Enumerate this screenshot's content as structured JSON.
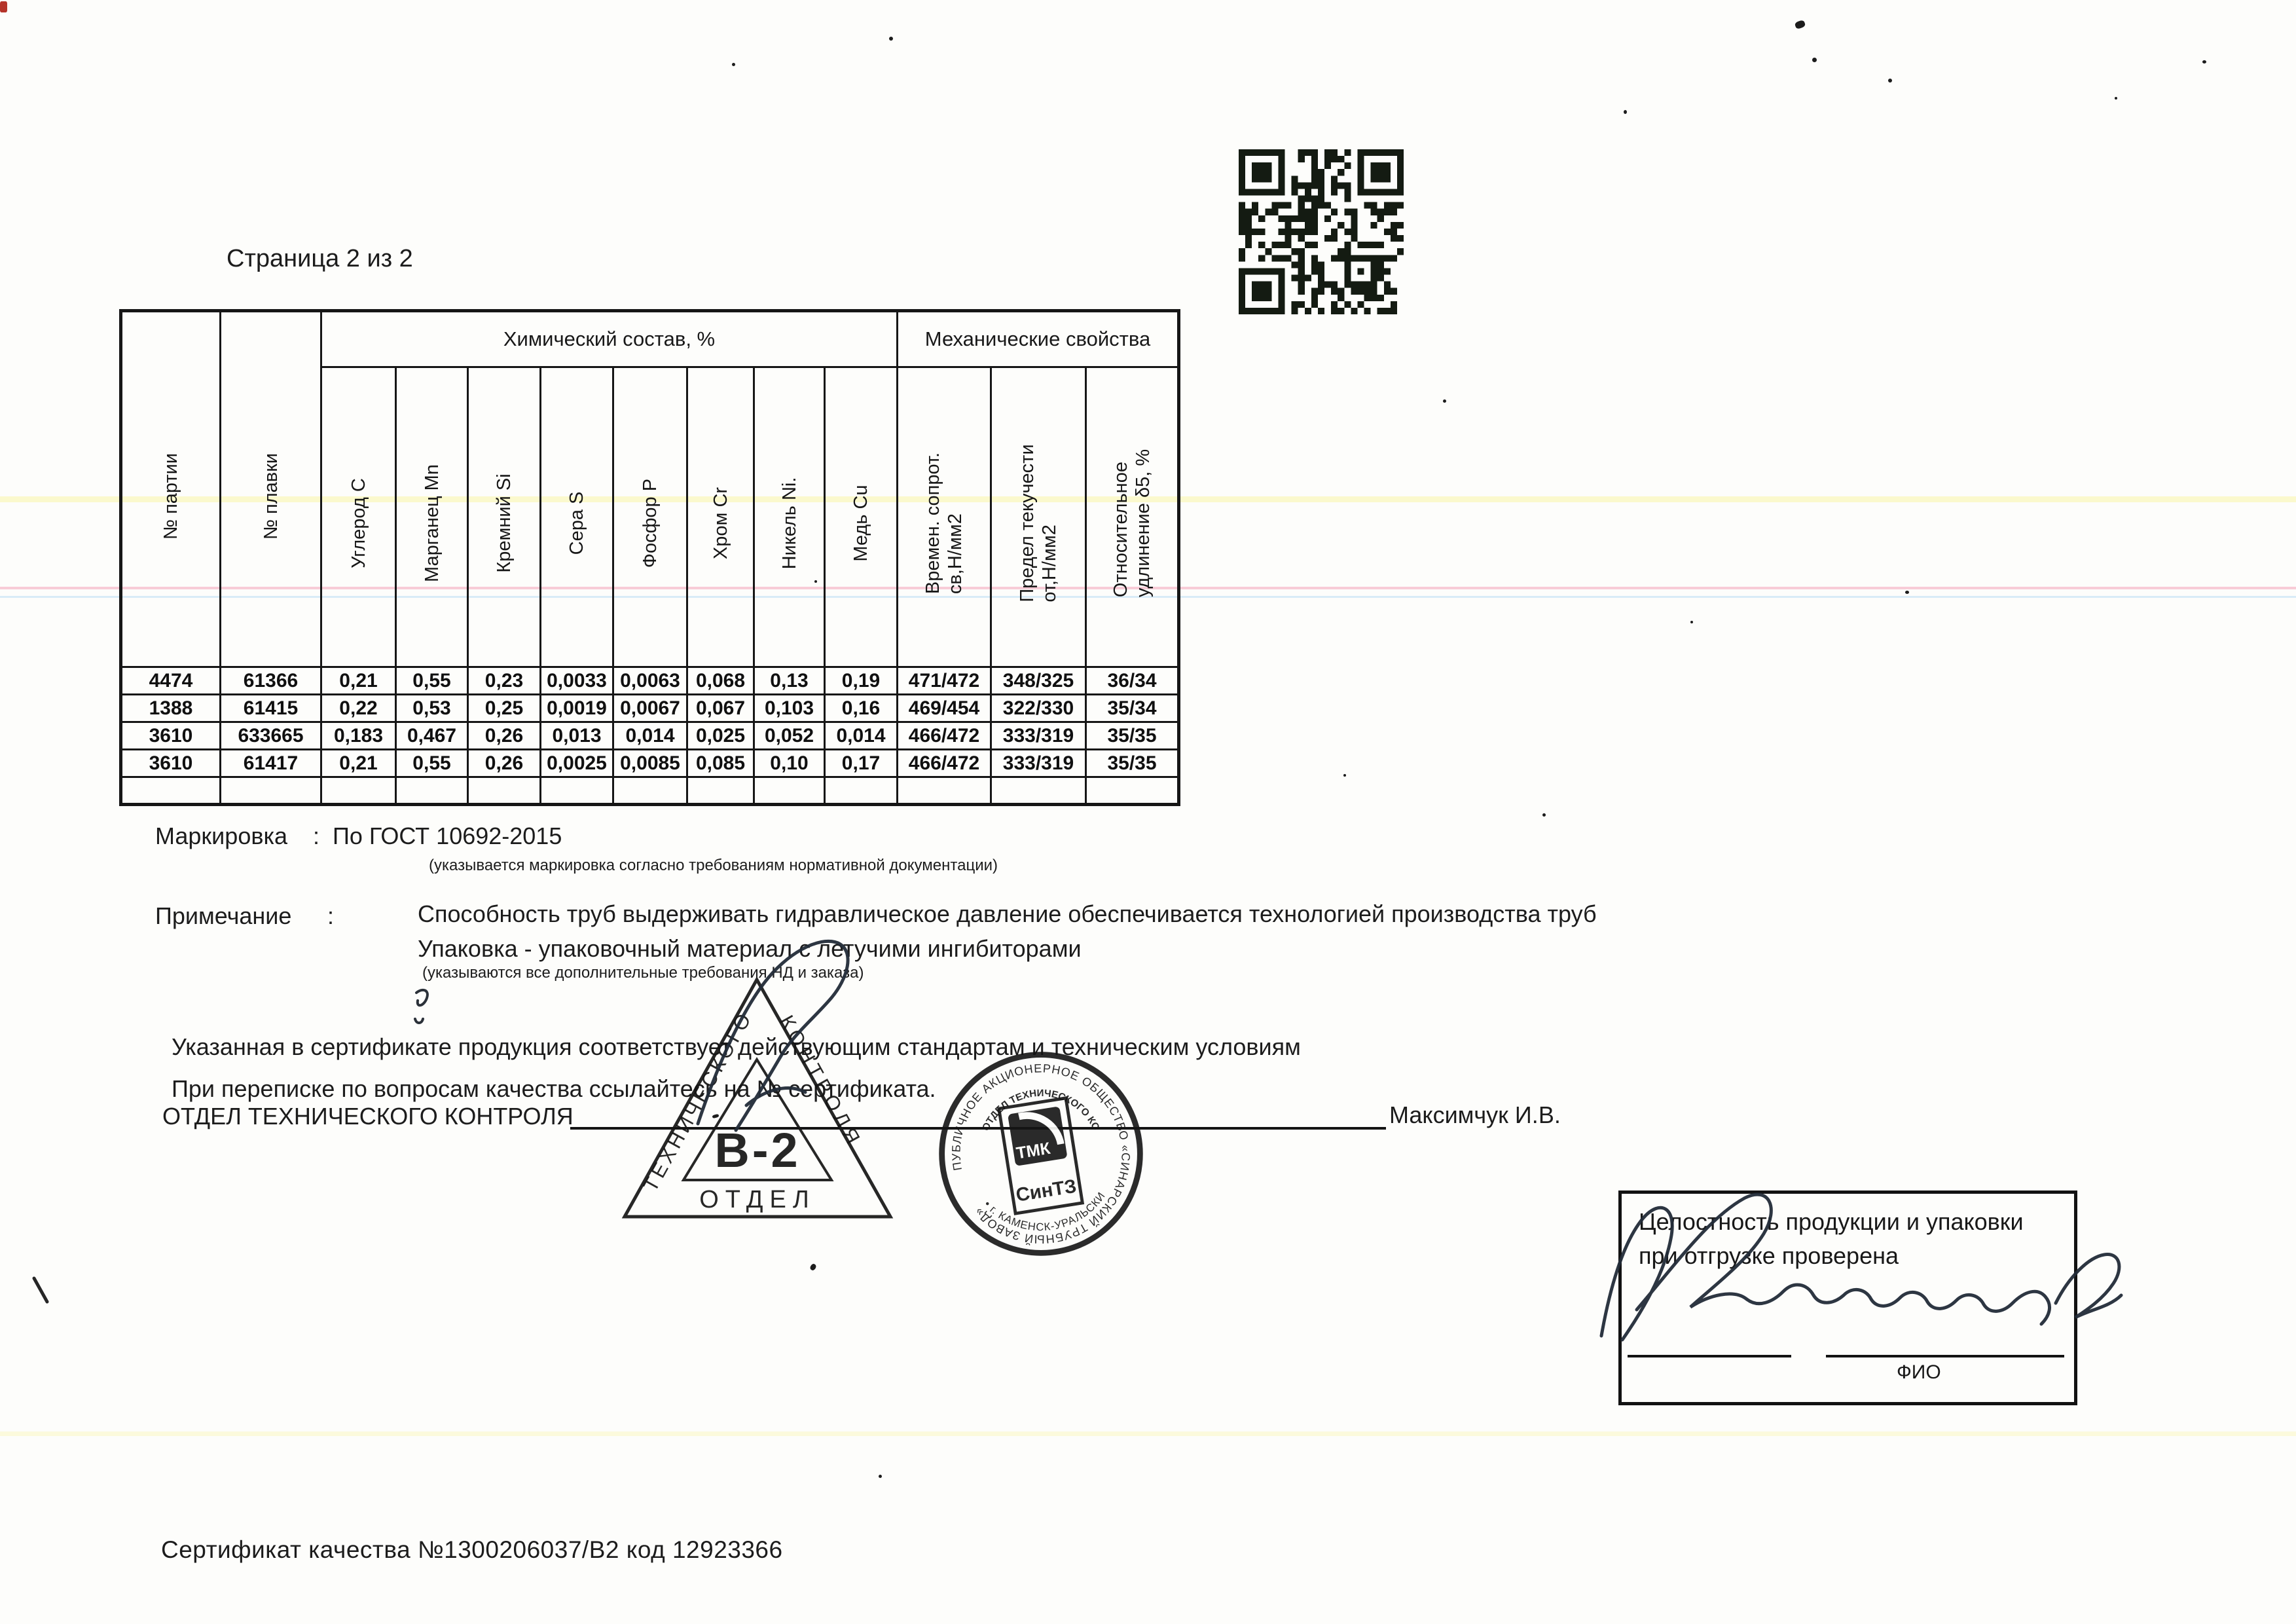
{
  "page": {
    "title": "Страница 2 из 2",
    "footer": "Сертификат качества №1300206037/В2 код 12923366"
  },
  "table": {
    "group_chemical": "Химический состав, %",
    "group_mechanical": "Механические свойства",
    "columns": [
      "№ партии",
      "№ плавки",
      "Углерод С",
      "Марганец Mn",
      "Кремний Si",
      "Сера S",
      "Фосфор Р",
      "Хром Cr",
      "Никель Ni.",
      "Медь Cu",
      "Времен. сопрот.\nсв,Н/мм2",
      "Предел текучести\nот,Н/мм2",
      "Относительное\nудлинение δ5, %"
    ],
    "rows": [
      [
        "4474",
        "61366",
        "0,21",
        "0,55",
        "0,23",
        "0,0033",
        "0,0063",
        "0,068",
        "0,13",
        "0,19",
        "471/472",
        "348/325",
        "36/34"
      ],
      [
        "1388",
        "61415",
        "0,22",
        "0,53",
        "0,25",
        "0,0019",
        "0,0067",
        "0,067",
        "0,103",
        "0,16",
        "469/454",
        "322/330",
        "35/34"
      ],
      [
        "3610",
        "633665",
        "0,183",
        "0,467",
        "0,26",
        "0,013",
        "0,014",
        "0,025",
        "0,052",
        "0,014",
        "466/472",
        "333/319",
        "35/35"
      ],
      [
        "3610",
        "61417",
        "0,21",
        "0,55",
        "0,26",
        "0,0025",
        "0,0085",
        "0,085",
        "0,10",
        "0,17",
        "466/472",
        "333/319",
        "35/35"
      ],
      [
        "",
        "",
        "",
        "",
        "",
        "",
        "",
        "",
        "",
        "",
        "",
        "",
        ""
      ]
    ]
  },
  "marking": {
    "label": "Маркировка",
    "colon": ":",
    "value": "По ГОСТ 10692-2015",
    "note": "(указывается маркировка согласно требованиям нормативной документации)"
  },
  "remark": {
    "label": "Примечание",
    "colon": ":",
    "line1": "Способность труб выдерживать гидравлическое давление обеспечивается технологией производства труб",
    "line2": "Упаковка  -  упаковочный материал с летучими ингибиторами",
    "sub": "(указываются все дополнительные требования НД и заказа)"
  },
  "statements": {
    "line1": "Указанная в сертификате продукция соответствует действующим стандартам и техническим условиям",
    "line2": "При переписке по вопросам качества ссылайтесь на № сертификата.",
    "dept": "ОТДЕЛ ТЕХНИЧЕСКОГО КОНТРОЛЯ",
    "signatory": "Максимчук И.В."
  },
  "stamps": {
    "triangle": {
      "side_left": "ТЕХНИЧЕСКОГО",
      "side_right": "КОНТРОЛЯ",
      "center": "В-2",
      "bottom": "ОТДЕЛ"
    },
    "round": {
      "ring": "ПУБЛИЧНОЕ АКЦИОНЕРНОЕ ОБЩЕСТВО «СИНАРСКИЙ ТРУБНЫЙ ЗАВОД»",
      "ring_bottom": "• г. КАМЕНСК-УРАЛЬСКИЙ •",
      "inner": "ОТДЕЛ ТЕХНИЧЕСКОГО КОНТРОЛЯ",
      "logo_top": "ТМК",
      "logo_bottom": "СинТЗ"
    }
  },
  "integrity_box": {
    "line1": "Целостность продукции и упаковки",
    "line2": "при отгрузке проверена",
    "fio": "ФИО"
  }
}
